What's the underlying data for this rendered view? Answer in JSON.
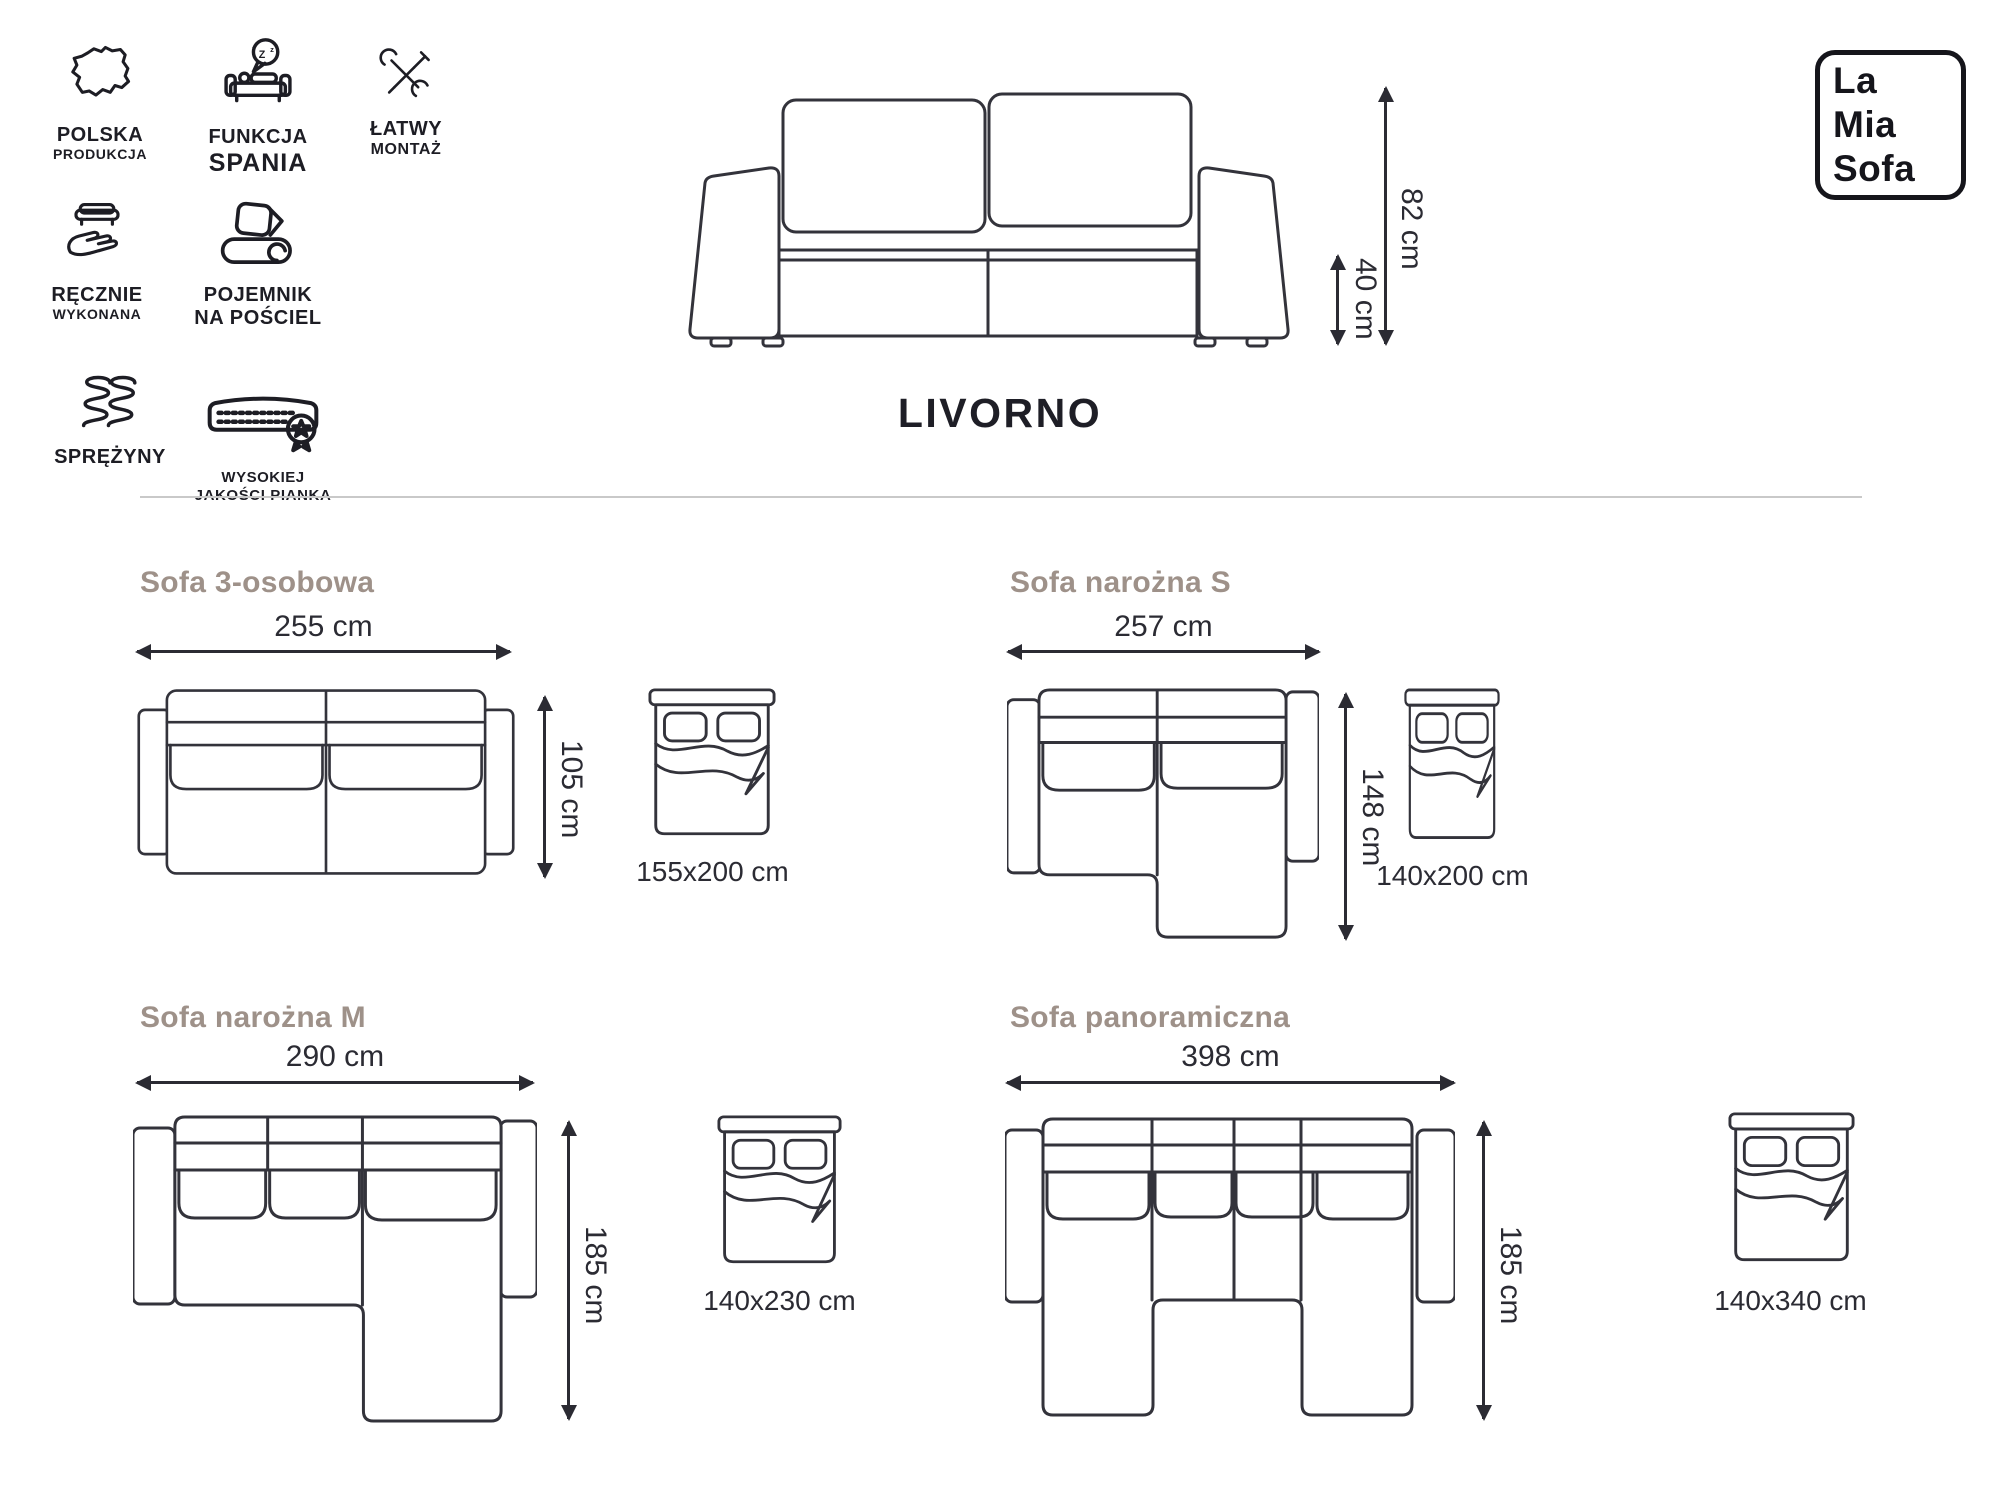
{
  "logo": {
    "line1": "La",
    "line2": "Mia",
    "line3": "Sofa"
  },
  "features": [
    {
      "id": "polska-produkcja",
      "line1": "POLSKA",
      "line2": "PRODUKCJA"
    },
    {
      "id": "funkcja-spania",
      "line1": "FUNKCJA",
      "line2": "SPANIA",
      "zzz": [
        "z",
        "Z",
        "z"
      ]
    },
    {
      "id": "latwy-montaz",
      "line1": "ŁATWY",
      "line2": "MONTAŻ"
    },
    {
      "id": "recznie-wykonana",
      "line1": "RĘCZNIE",
      "line2": "WYKONANA"
    },
    {
      "id": "pojemnik-na-posciel",
      "line1": "POJEMNIK",
      "line2": "NA POŚCIEL"
    },
    {
      "id": "sprezyny",
      "line1": "SPRĘŻYNY",
      "line2": ""
    },
    {
      "id": "wysokiej-jakosci-pianka",
      "line1": "WYSOKIEJ",
      "line2": "JAKOŚCI PIANKA"
    }
  ],
  "product": {
    "name": "LIVORNO",
    "total_height": "82 cm",
    "seat_height": "40 cm"
  },
  "variants": [
    {
      "name": "Sofa 3-osobowa",
      "width": "255 cm",
      "depth": "105 cm",
      "sleeping_area": "155x200 cm"
    },
    {
      "name": "Sofa narożna S",
      "width": "257 cm",
      "depth": "148 cm",
      "sleeping_area": "140x200 cm"
    },
    {
      "name": "Sofa narożna M",
      "width": "290 cm",
      "depth": "185 cm",
      "sleeping_area": "140x230 cm"
    },
    {
      "name": "Sofa panoramiczna",
      "width": "398 cm",
      "depth": "185 cm",
      "sleeping_area": "140x340 cm"
    }
  ],
  "colors": {
    "line": "#33333b",
    "icon": "#1d1d24",
    "heading": "#9e9189",
    "dimension_text": "#2b2b33",
    "divider": "#c9c9c9"
  }
}
